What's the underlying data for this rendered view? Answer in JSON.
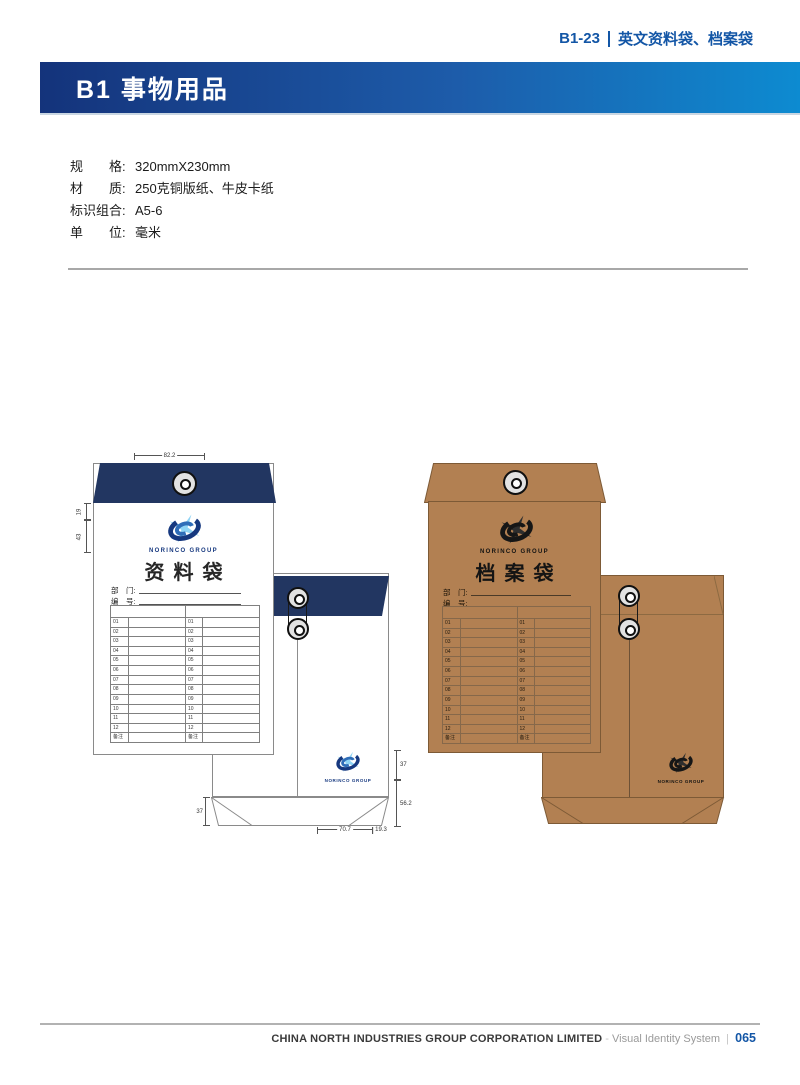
{
  "header": {
    "code": "B1-23",
    "code_title": "英文资料袋、档案袋",
    "section_title": "B1 事物用品"
  },
  "specs": [
    {
      "label": "规　　格:",
      "value": "320mmX230mm"
    },
    {
      "label": "材　　质:",
      "value": "250克铜版纸、牛皮卡纸"
    },
    {
      "label": "标识组合:",
      "value": "A5-6"
    },
    {
      "label": "单　　位:",
      "value": "毫米"
    }
  ],
  "envelopes": {
    "left": {
      "title": "资料袋",
      "brand": "NORINCO GROUP",
      "dept_label": "部　门:",
      "no_label": "编　号:",
      "rows": [
        "01",
        "02",
        "03",
        "04",
        "05",
        "06",
        "07",
        "08",
        "09",
        "10",
        "11",
        "12",
        "备注"
      ],
      "dims": {
        "top_width": "82.2",
        "left_upper": "19",
        "left_lower": "43",
        "back_right_upper": "37",
        "back_right_lower": "56.2",
        "back_left_flap": "37",
        "back_bottom_main": "70.7",
        "back_bottom_edge": "19.3"
      }
    },
    "right": {
      "title": "档案袋",
      "brand": "NORINCO GROUP",
      "dept_label": "部　门:",
      "no_label": "编　号:",
      "rows": [
        "01",
        "02",
        "03",
        "04",
        "05",
        "06",
        "07",
        "08",
        "09",
        "10",
        "11",
        "12",
        "备注"
      ]
    }
  },
  "footer": {
    "company": "CHINA NORTH INDUSTRIES GROUP CORPORATION LIMITED",
    "dash": " - ",
    "system": "Visual Identity System",
    "separator": "  |  ",
    "page": "065"
  },
  "colors": {
    "navy": "#223661",
    "kraft": "#b28052",
    "kraft_line": "#7d5a36",
    "accent": "#1356a6",
    "header_gradient_left": "#14337b",
    "header_gradient_right": "#0d8bd1",
    "logo_dark_blue": "#16387f",
    "logo_mid_blue": "#2f6db8",
    "logo_star_blue": "#8fd4f5",
    "table_line": "#8a8a8a"
  }
}
